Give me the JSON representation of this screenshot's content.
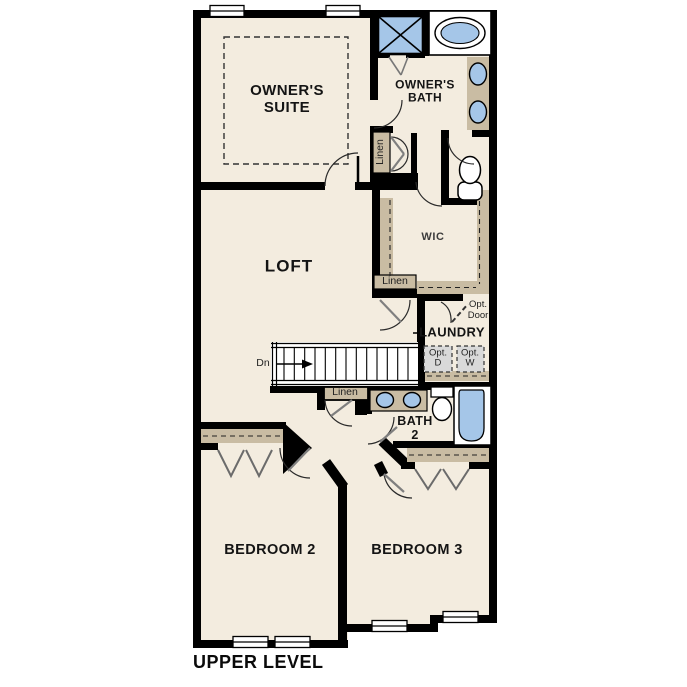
{
  "caption": "UPPER LEVEL",
  "palette": {
    "floor": "#f3ecdf",
    "wall": "#000000",
    "millwork_tan": "#c9bca3",
    "fixture_blue": "#a5c6e8",
    "optional_gray": "#d9d9d9",
    "door_leaf_gray": "#7f7f7f"
  },
  "rooms": {
    "owners_suite": {
      "line1": "OWNER'S",
      "line2": "SUITE"
    },
    "owners_bath": {
      "line1": "OWNER'S",
      "line2": "BATH"
    },
    "loft": {
      "label": "LOFT"
    },
    "wic": {
      "label": "WIC"
    },
    "laundry": {
      "label": "LAUNDRY"
    },
    "bath2": {
      "line1": "BATH",
      "line2": "2"
    },
    "bedroom2": {
      "label": "BEDROOM 2"
    },
    "bedroom3": {
      "label": "BEDROOM 3"
    }
  },
  "closets": {
    "linen_upper": "Linen",
    "linen_mid": "Linen",
    "linen_lower": "Linen"
  },
  "optional_items": {
    "door": {
      "line1": "Opt.",
      "line2": "Door"
    },
    "dryer": {
      "line1": "Opt.",
      "line2": "D"
    },
    "washer": {
      "line1": "Opt.",
      "line2": "W"
    }
  },
  "stairs": {
    "down_label": "Dn"
  },
  "icons": {
    "shower": "crossed-square",
    "bathtub": "double-oval-in-deck",
    "sink": "oval-basin",
    "toilet": "tank-and-bowl",
    "window": "double-line-bar",
    "bifold_door": "zigzag-v",
    "stairs_direction": "right-arrow"
  }
}
